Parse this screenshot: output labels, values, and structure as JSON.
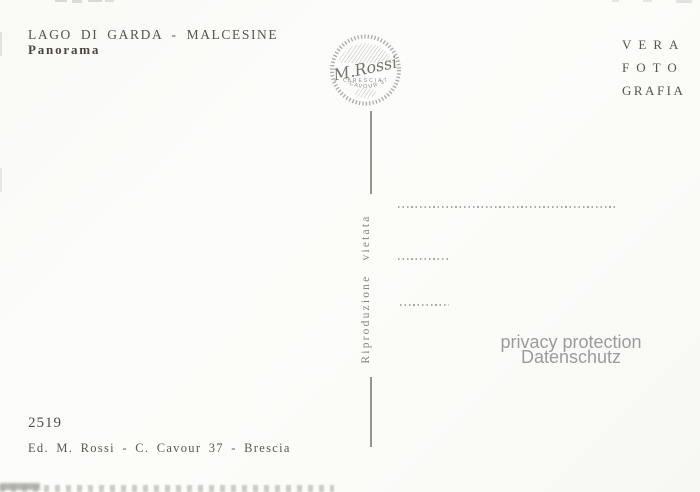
{
  "colors": {
    "paper": "#fbfbf8",
    "ink": "#56544c",
    "faint_ink": "#8d8d85",
    "divider_gray": "#95958d",
    "watermark_gray": "#9b9b9b"
  },
  "header": {
    "title": "LAGO DI GARDA - MALCESINE",
    "subtitle": "Panorama"
  },
  "stamp": {
    "name": "M.Rossi",
    "city": "BRESCIA",
    "address": "C.CAVOUR 37"
  },
  "right_header": {
    "line1": "VERA",
    "line2": "FOTO",
    "line3": "GRAFIA"
  },
  "divider": {
    "label": "Riproduzione vietata"
  },
  "watermark": {
    "line1": "privacy protection",
    "line2": "Datenschutz"
  },
  "footer": {
    "number": "2519",
    "publisher": "Ed. M. Rossi - C. Cavour 37 - Brescia"
  }
}
